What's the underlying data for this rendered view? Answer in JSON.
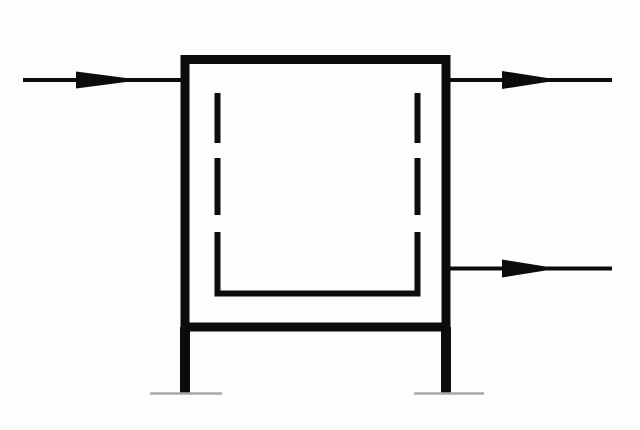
{
  "title": "Process equipment schematic symbol",
  "colors": {
    "background": "#fdfdfd",
    "line": "#0c0c0c",
    "ground": "#a8a8a8"
  },
  "diagram": {
    "type": "schematic-symbol",
    "description": "Square vessel with a dashed inner liner open at the top and a solid liner bottom, one inlet arrow entering at the upper left, two outlet arrows leaving at the upper right and middle right, supported by two legs resting on thin ground baselines",
    "components": [
      {
        "name": "outer-vessel",
        "shape": "square outline",
        "style": "solid thick black"
      },
      {
        "name": "inner-liner",
        "shape": "inner square open at top",
        "style": "dashed sides, solid bottom corners and base"
      },
      {
        "name": "inlet-arrow",
        "side": "left",
        "direction": "right",
        "row": "top"
      },
      {
        "name": "outlet-arrow-top",
        "side": "right",
        "direction": "right",
        "row": "top"
      },
      {
        "name": "outlet-arrow-bottom",
        "side": "right",
        "direction": "right",
        "row": "middle"
      },
      {
        "name": "support-leg-left",
        "shape": "vertical leg"
      },
      {
        "name": "support-leg-right",
        "shape": "vertical leg"
      },
      {
        "name": "ground-mark-left",
        "shape": "thin horizontal baseline",
        "color_role": "ground"
      },
      {
        "name": "ground-mark-right",
        "shape": "thin horizontal baseline",
        "color_role": "ground"
      }
    ]
  }
}
